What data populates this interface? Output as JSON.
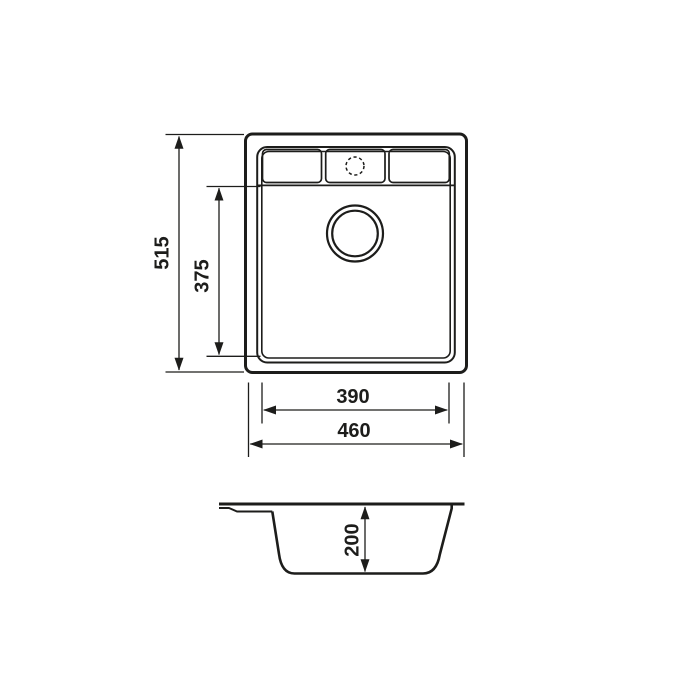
{
  "drawing": {
    "dimensions": {
      "overall_length": "515",
      "bowl_length": "375",
      "bowl_width": "390",
      "overall_width": "460",
      "bowl_depth": "200"
    },
    "colors": {
      "line": "#1d1d1b",
      "background": "#ffffff"
    }
  }
}
